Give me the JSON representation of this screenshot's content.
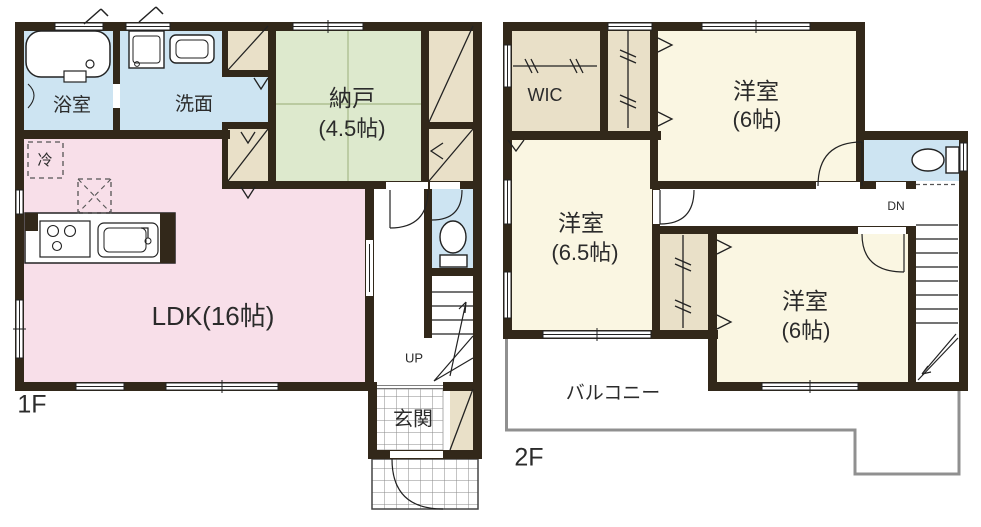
{
  "plan_title": "house-floor-plan",
  "colors": {
    "wall": "#32281a",
    "water_room": "#cde4f2",
    "storage_green": "#dde9cd",
    "ldk_pink": "#f8dfe9",
    "closet_tan": "#e9e0c8",
    "bedroom_cream": "#faf6e2",
    "balcony_line": "#909090",
    "text": "#2b2b2b"
  },
  "floor1": {
    "label": "1F",
    "bathroom": "浴室",
    "washroom": "洗面",
    "storage": "納戸",
    "storage_size": "(4.5帖)",
    "fridge": "冷",
    "ldk": "LDK(16帖)",
    "stairs_direction": "UP",
    "entrance": "玄関"
  },
  "floor2": {
    "label": "2F",
    "wic": "WIC",
    "bedroom_ne": "洋室",
    "bedroom_ne_size": "(6帖)",
    "bedroom_w": "洋室",
    "bedroom_w_size": "(6.5帖)",
    "bedroom_se": "洋室",
    "bedroom_se_size": "(6帖)",
    "stairs_direction": "DN",
    "balcony": "バルコニー"
  },
  "icons": {
    "bathtub": "bathtub-icon",
    "washing_machine": "washing-machine-icon",
    "wash_basin": "wash-basin-icon",
    "gas_stove": "gas-stove-icon",
    "kitchen_sink": "kitchen-sink-icon",
    "toilet": "toilet-icon",
    "refrigerator_space": "refrigerator-space-icon",
    "door_swing": "door-arc-icon",
    "closet_hanger": "hanger-rod-icon"
  }
}
